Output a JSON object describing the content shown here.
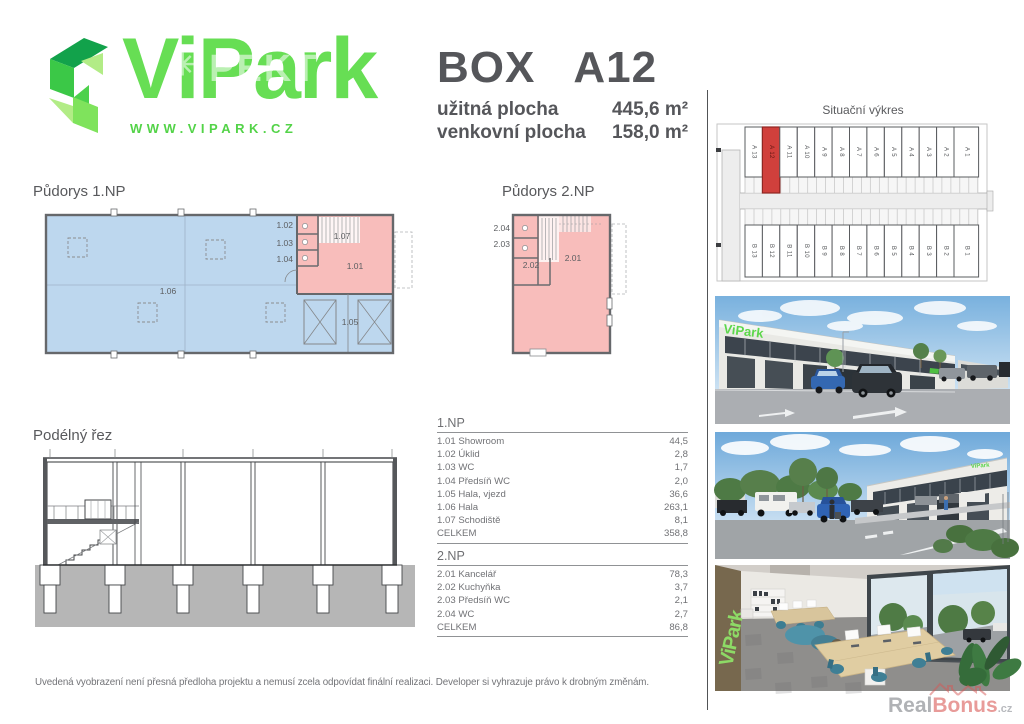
{
  "brand": {
    "name": "ViPark",
    "website": "WWW.VIPARK.CZ",
    "overlay_watermark": "PEKT",
    "green": "#5fd84d"
  },
  "header": {
    "box_label": "BOX",
    "unit": "A12",
    "specs": [
      {
        "label": "užitná plocha",
        "value": "445,6 m²"
      },
      {
        "label": "venkovní plocha",
        "value": "158,0 m²"
      }
    ]
  },
  "situation": {
    "title": "Situační výkres",
    "highlight": "A 12",
    "highlight_color": "#d0403c",
    "row_a": [
      "A 13",
      "A 12",
      "A 11",
      "A 10",
      "A 9",
      "A 8",
      "A 7",
      "A 6",
      "A 5",
      "A 4",
      "A 3",
      "A 2",
      "A 1"
    ],
    "row_b": [
      "B 13",
      "B 12",
      "B 11",
      "B 10",
      "B 9",
      "B 8",
      "B 7",
      "B 6",
      "B 5",
      "B 4",
      "B 3",
      "B 2",
      "B 1"
    ]
  },
  "plans": {
    "floor1": {
      "title": "Půdorys 1.NP",
      "labels": {
        "l101": "1.01",
        "l102": "1.02",
        "l103": "1.03",
        "l104": "1.04",
        "l105": "1.05",
        "l106": "1.06",
        "l107": "1.07"
      }
    },
    "floor2": {
      "title": "Půdorys 2.NP",
      "labels": {
        "l201": "2.01",
        "l202": "2.02",
        "l203": "2.03",
        "l204": "2.04"
      }
    },
    "section": {
      "title": "Podélný řez"
    }
  },
  "tables": {
    "floor1": {
      "title": "1.NP",
      "rows": [
        {
          "name": "1.01 Showroom",
          "area": "44,5"
        },
        {
          "name": "1.02 Úklid",
          "area": "2,8"
        },
        {
          "name": "1.03 WC",
          "area": "1,7"
        },
        {
          "name": "1.04 Předsíň WC",
          "area": "2,0"
        },
        {
          "name": "1.05 Hala, vjezd",
          "area": "36,6"
        },
        {
          "name": "1.06 Hala",
          "area": "263,1"
        },
        {
          "name": "1.07 Schodiště",
          "area": "8,1"
        }
      ],
      "total": {
        "name": "CELKEM",
        "area": "358,8"
      }
    },
    "floor2": {
      "title": "2.NP",
      "rows": [
        {
          "name": "2.01 Kancelář",
          "area": "78,3"
        },
        {
          "name": "2.02 Kuchyňka",
          "area": "3,7"
        },
        {
          "name": "2.03 Předsíň WC",
          "area": "2,1"
        },
        {
          "name": "2.04 WC",
          "area": "2,7"
        }
      ],
      "total": {
        "name": "CELKEM",
        "area": "86,8"
      }
    }
  },
  "photos": [
    {
      "name": "exterior-front-parking-render"
    },
    {
      "name": "exterior-street-view-render"
    },
    {
      "name": "office-interior-render"
    }
  ],
  "footer": {
    "disclaimer": "Uvedená vyobrazení není přesná předloha projektu a nemusí zcela odpovídat finální realizaci. Developer si vyhrazuje právo k drobným změnám.",
    "watermark": {
      "gray": "Real",
      "red": "Bonus",
      "suffix": ".cz"
    }
  }
}
